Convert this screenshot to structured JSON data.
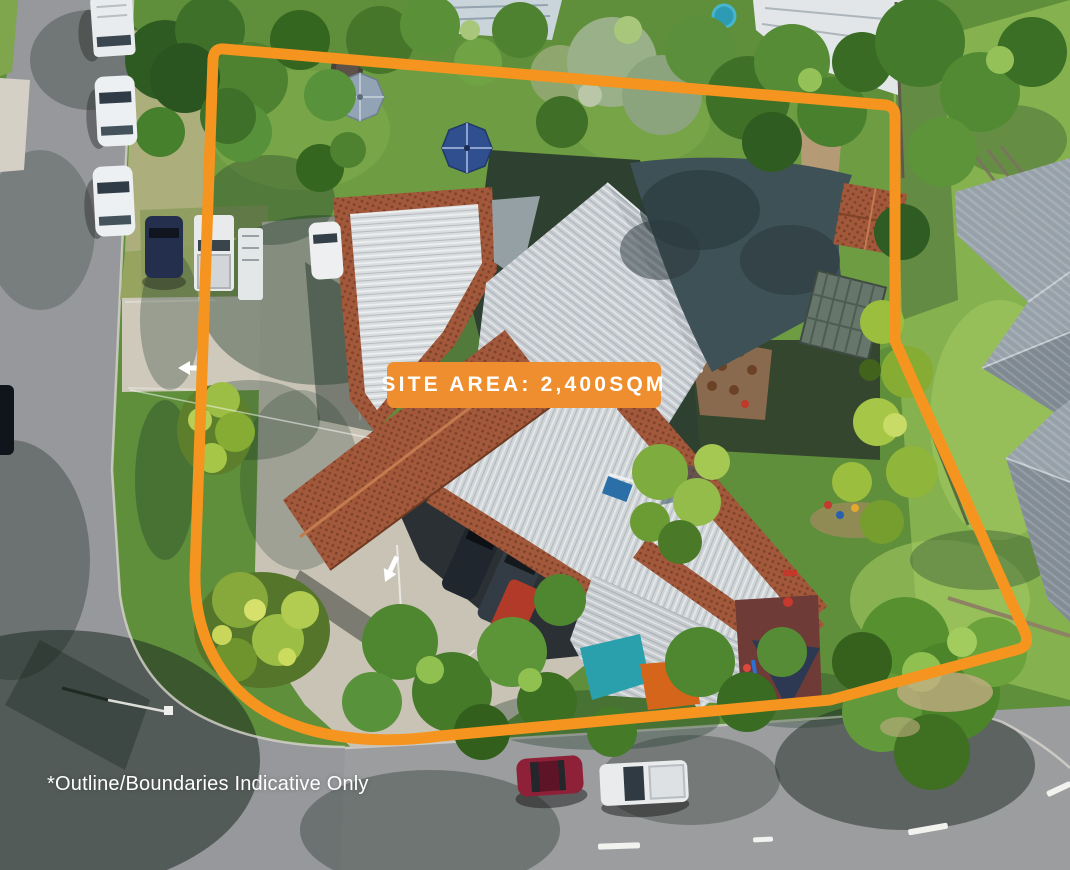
{
  "overlay": {
    "site_area_label": "SITE AREA: 2,400SQM",
    "disclaimer": "*Outline/Boundaries Indicative Only"
  },
  "palette": {
    "accent_orange": "#F5951F",
    "badge_orange": "#EE8E2E",
    "overlay_text": "#FFFFFF",
    "road_gray": "#96989B",
    "concrete": "#C9C3B6",
    "lawn_green": "#6E9C42",
    "tree_green": "#4A7A2C",
    "terracotta_roof": "#A2583A",
    "metal_roof": "#CFD4D7",
    "dark_shade_sail": "#3E5156",
    "neighbor_roof_gray": "#99A3AB",
    "teal_sail": "#2AA0AC",
    "sandpit_orange": "#D4651A"
  }
}
